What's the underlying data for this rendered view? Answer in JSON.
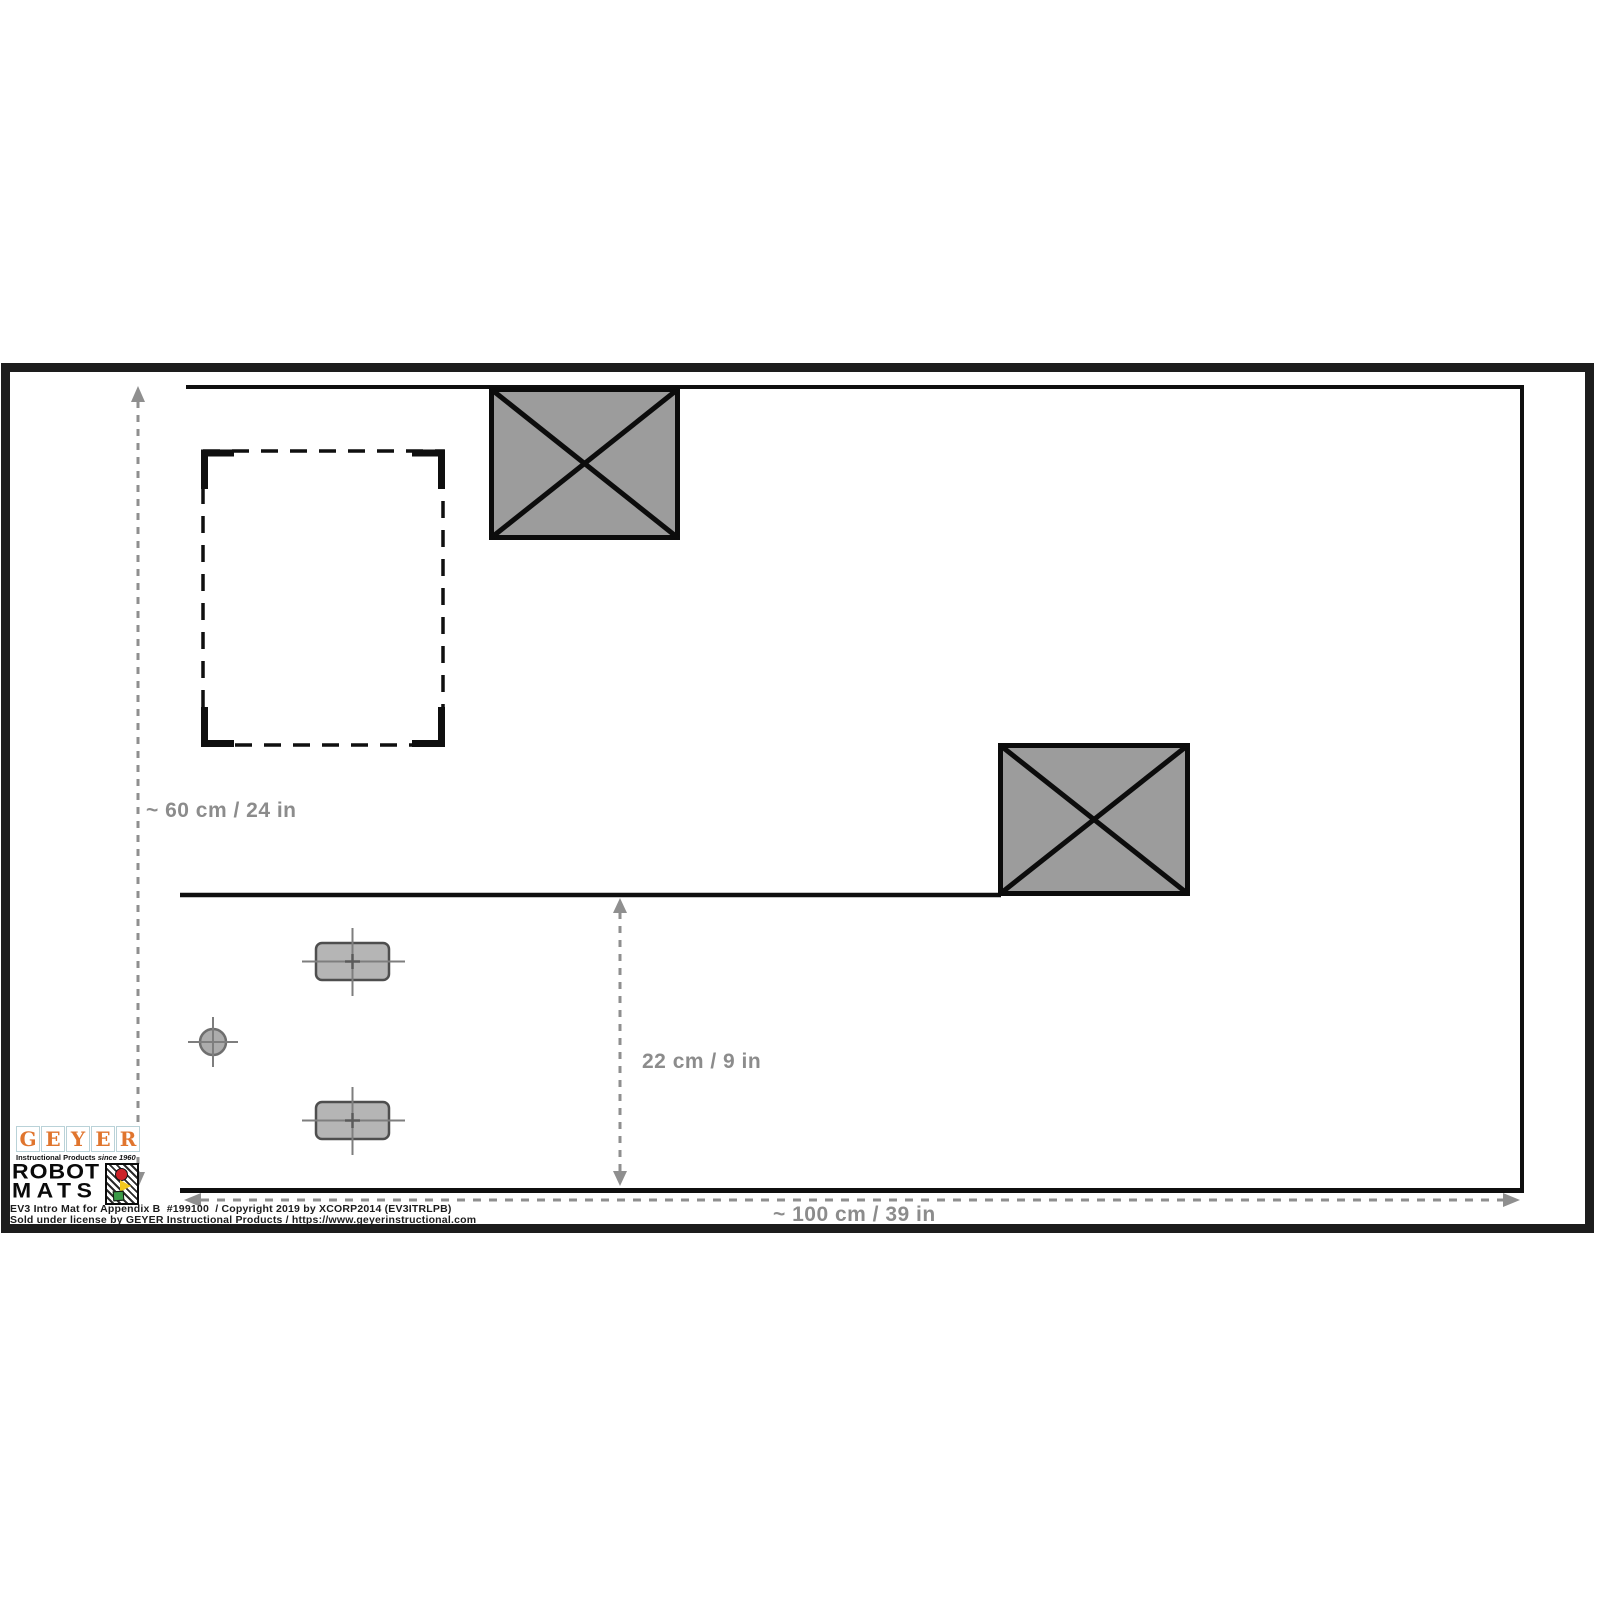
{
  "diagram": {
    "title_hint": "EV3 robot training mat layout",
    "dimensions": {
      "mat_height_label": "~ 60 cm / 24 in",
      "lower_zone_height_label": "22 cm / 9 in",
      "mat_width_label": "~ 100 cm / 39 in"
    }
  },
  "branding": {
    "geyer": {
      "letters": [
        "G",
        "E",
        "Y",
        "E",
        "R"
      ],
      "tagline": "Instructional Products ",
      "tagline_suffix": "since 1960"
    },
    "robot_mats": {
      "line1": "ROBOT",
      "line2": "MATS",
      "badge_icons": [
        "red-circle",
        "yellow-triangle",
        "green-square"
      ]
    }
  },
  "footer": {
    "line1": "EV3 Intro Mat for Appendix B  #199100  / Copyright 2019 by XCORP2014 (EV3ITRLPB)",
    "line2": "Sold under license by GEYER Instructional Products / https://www.geyerinstructional.com"
  },
  "colors": {
    "line_black": "#101010",
    "dimension_gray": "#8c8c8c",
    "obstacle_fill": "#9c9c9c",
    "block_fill": "#b5b5b5",
    "geyer_orange": "#e0752e",
    "badge_red": "#cc2229",
    "badge_yellow": "#f2c81e",
    "badge_green": "#3a9a48"
  }
}
